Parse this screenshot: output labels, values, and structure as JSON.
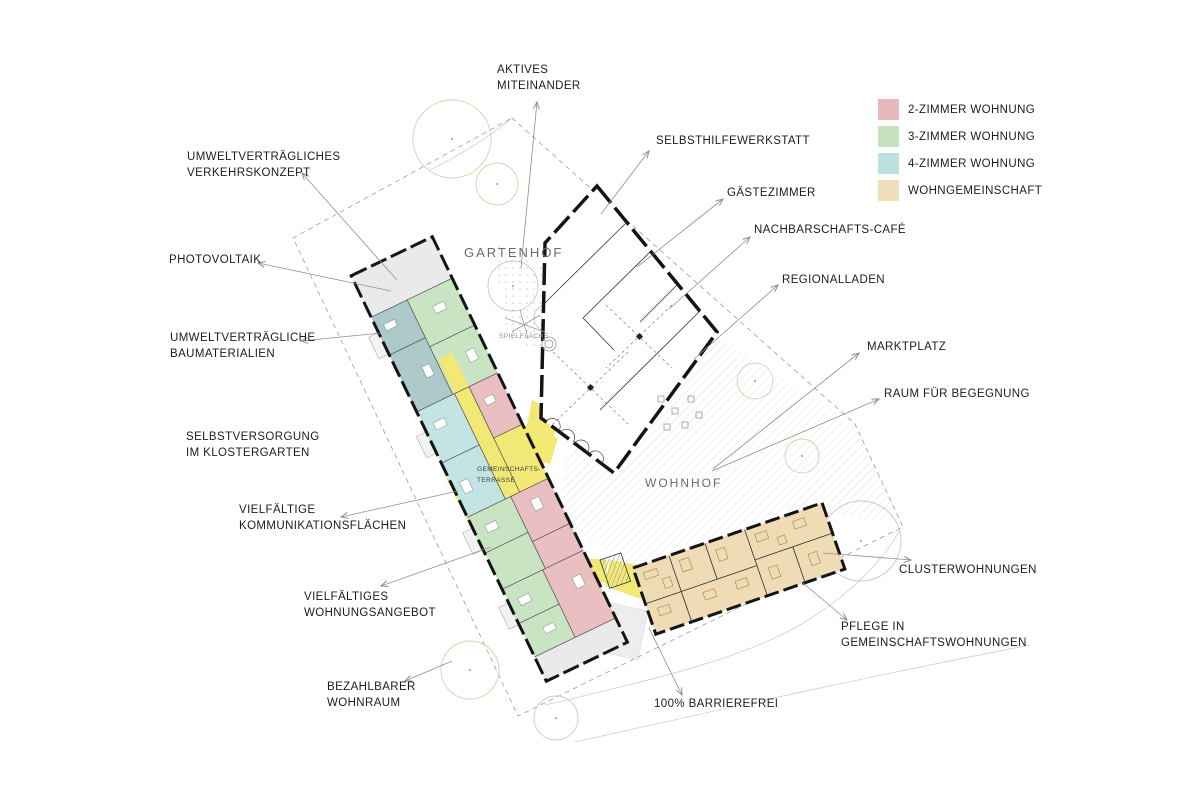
{
  "legend": {
    "items": [
      {
        "label": "2-ZIMMER WOHNUNG",
        "color": "#e7b9bd"
      },
      {
        "label": "3-ZIMMER WOHNUNG",
        "color": "#c7e2c0"
      },
      {
        "label": "4-ZIMMER WOHNUNG",
        "color": "#bfe0e3"
      },
      {
        "label": "WOHNGEMEINSCHAFT",
        "color": "#f1dfb9"
      }
    ]
  },
  "annotations": {
    "aktives": {
      "line1": "AKTIVES",
      "line2": "MITEINANDER"
    },
    "selbsthilfewerkstatt": {
      "line1": "SELBSTHILFEWERKSTATT"
    },
    "gaestezimmer": {
      "line1": "GÄSTEZIMMER"
    },
    "cafe": {
      "line1": "NACHBARSCHAFTS-CAFÉ"
    },
    "regionalladen": {
      "line1": "REGIONALLADEN"
    },
    "marktplatz": {
      "line1": "MARKTPLATZ"
    },
    "begegnung": {
      "line1": "RAUM FÜR BEGEGNUNG"
    },
    "verkehrskonzept": {
      "line1": "UMWELTVERTRÄGLICHES",
      "line2": "VERKEHRSKONZEPT"
    },
    "photovoltaik": {
      "line1": "PHOTOVOLTAIK"
    },
    "baumaterialien": {
      "line1": "UMWELTVERTRÄGLICHE",
      "line2": "BAUMATERIALIEN"
    },
    "selbstversorgung": {
      "line1": "SELBSTVERSORGUNG",
      "line2": "IM KLOSTERGARTEN"
    },
    "kommunikation": {
      "line1": "VIELFÄLTIGE",
      "line2": "KOMMUNIKATIONSFLÄCHEN"
    },
    "wohnungsangebot": {
      "line1": "VIELFÄLTIGES",
      "line2": "WOHNUNGSANGEBOT"
    },
    "bezahlbar": {
      "line1": "BEZAHLBARER",
      "line2": "WOHNRAUM"
    },
    "barrierefrei": {
      "line1": "100% BARRIEREFREI"
    },
    "cluster": {
      "line1": "CLUSTERWOHNUNGEN"
    },
    "pflege": {
      "line1": "PFLEGE IN",
      "line2": "GEMEINSCHAFTSWOHNUNGEN"
    }
  },
  "plan_labels": {
    "gartenhof": "GARTENHOF",
    "spielflaeche": "SPIELFLÄCHE",
    "terrasse_line1": "GEMEINSCHAFTS-",
    "terrasse_line2": "TERRASSE",
    "wohnhof": "WOHNHOF"
  },
  "colors": {
    "apartment_2room_pink": "#e7b9bd",
    "apartment_3room_green": "#c7e2c0",
    "apartment_4room_blue": "#bfe0e3",
    "wohngemeinschaft_tan": "#f1dfb9",
    "community_yellow": "#f2e876",
    "teal_dark_unit": "#adc9c9",
    "neutral_unit_grey": "#eaeaea",
    "wall_black": "#141414",
    "leader_line_grey": "#8f8f8f"
  }
}
